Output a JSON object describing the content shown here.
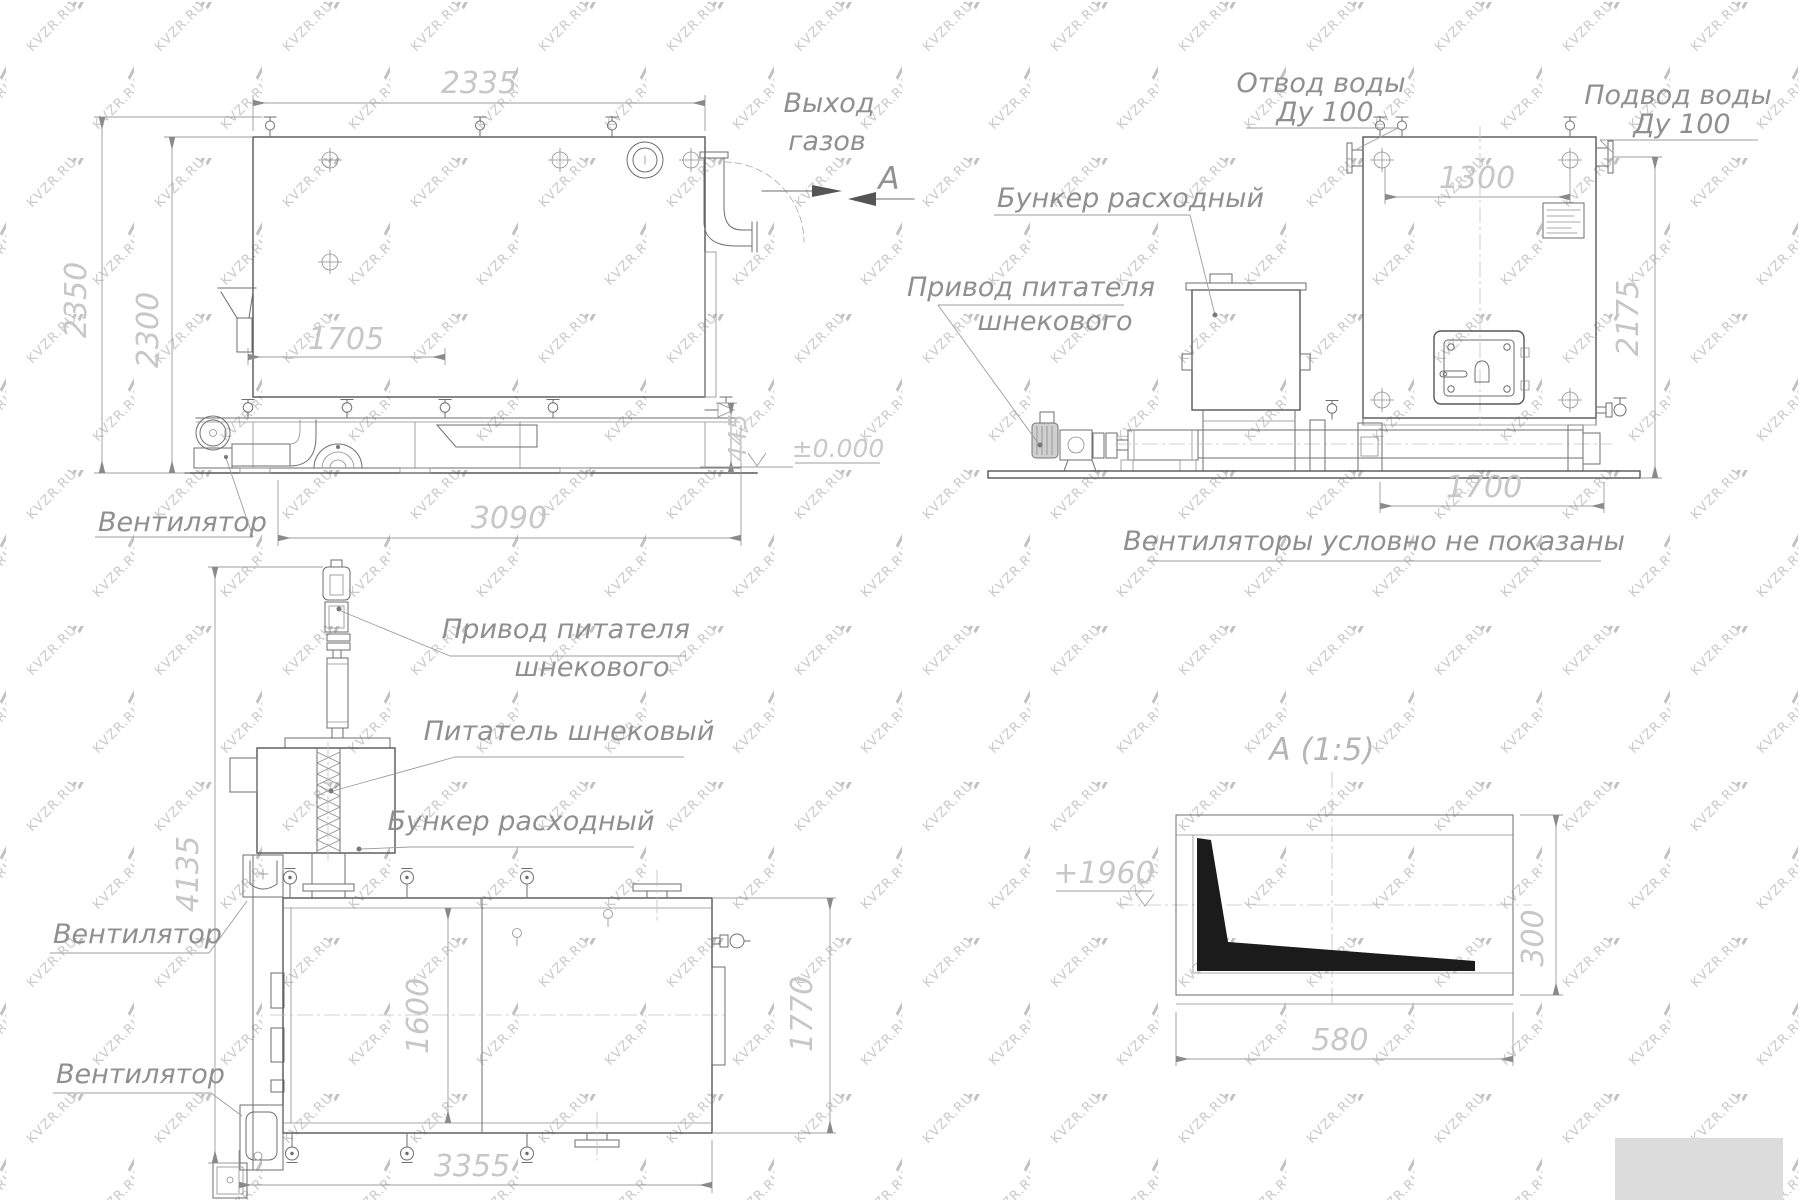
{
  "watermark": {
    "text": "KVZR.RU"
  },
  "side_view": {
    "labels": {
      "gas_out_line1": "Выход",
      "gas_out_line2": "газов",
      "section_letter": "А",
      "fan": "Вентилятор"
    },
    "dims": {
      "top_width": "2335",
      "overall_height": "2350",
      "body_height": "2300",
      "grate_length": "1705",
      "overall_length": "3090",
      "base_height": "445",
      "ground_level": "±0.000"
    }
  },
  "front_view": {
    "labels": {
      "water_outlet_line1": "Отвод воды",
      "water_outlet_line2": "Ду 100",
      "water_inlet_line1": "Подвод воды",
      "water_inlet_line2": "Ду 100",
      "hopper": "Бункер расходный",
      "drive_line1": "Привод питателя",
      "drive_line2": "шнекового"
    },
    "dims": {
      "valve_span": "1300",
      "overall_height": "2175",
      "base_length": "1700"
    },
    "note": "Вентиляторы условно не показаны"
  },
  "plan_view": {
    "labels": {
      "drive_line1": "Привод питателя",
      "drive_line2": "шнекового",
      "screw_feeder": "Питатель шнековый",
      "hopper": "Бункер расходный",
      "fan_upper": "Вентилятор",
      "fan_lower": "Вентилятор"
    },
    "dims": {
      "overall_depth": "4135",
      "inner_width": "1600",
      "boiler_width": "1770",
      "overall_length": "3355"
    }
  },
  "detail_view": {
    "title": "А  (1:5)",
    "dims": {
      "elevation": "+1960",
      "width": "580",
      "height": "300"
    }
  }
}
